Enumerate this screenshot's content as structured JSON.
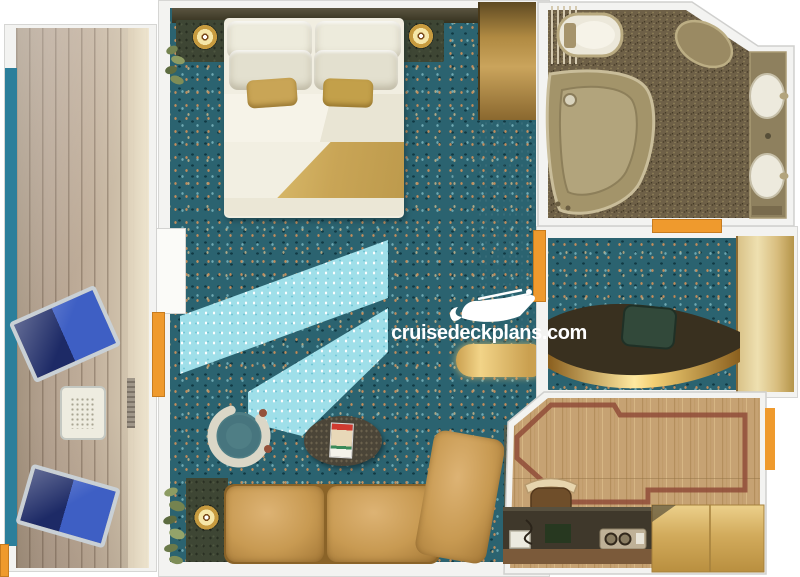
{
  "watermark": {
    "text": "cruisedeckplans.com",
    "icon": "cruise-ship-icon"
  },
  "palette": {
    "carpet_teal": "#2b6370",
    "light_shaft": "#9fdfe9",
    "accent_orange": "#ef9a2d",
    "balcony_edge_teal": "#2c7f9b",
    "deck_wood": "#b5a391",
    "gold_furniture": "#cfa85c",
    "sofa_leather": "#c89a52",
    "bed_linen": "#f2efe4",
    "bed_gold": "#c9a556",
    "bathroom_floor": "#6e6047",
    "wood_floor": "#c6a273",
    "inlay_red": "#8f4c38",
    "wall_white": "#f3f3f1"
  },
  "rooms": [
    {
      "name": "balcony",
      "items": [
        "lounge-chair",
        "lounge-chair",
        "balcony-table",
        "deck-vent"
      ]
    },
    {
      "name": "cabin",
      "items": [
        "double-bed",
        "nightstand",
        "nightstand",
        "table-lamp",
        "table-lamp",
        "wardrobe",
        "vanity-counter",
        "sofa",
        "chaise",
        "barrel-chair",
        "coffee-table",
        "magazine",
        "side-table",
        "plant",
        "plant",
        "balcony-door"
      ]
    },
    {
      "name": "bathroom",
      "items": [
        "bathtub",
        "toilet",
        "bidet",
        "sink",
        "sink",
        "towel-rack",
        "sink-counter"
      ]
    },
    {
      "name": "dressing-room",
      "items": [
        "vanity-desk",
        "desk-chair",
        "mirror-panel"
      ]
    },
    {
      "name": "lounge-room",
      "items": [
        "wood-floor",
        "floor-inlay",
        "bar-counter",
        "stool",
        "mini-fridge",
        "coffee-tray",
        "storage-cabinet"
      ]
    }
  ]
}
